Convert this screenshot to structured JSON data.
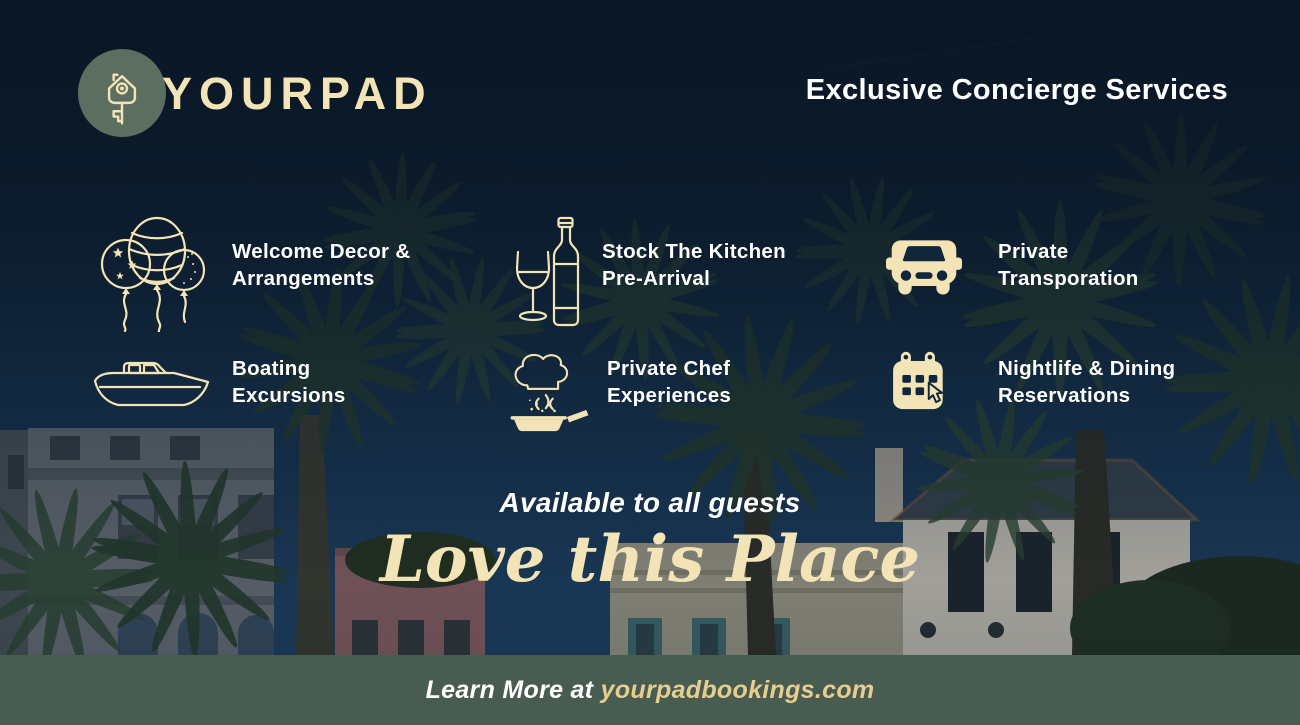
{
  "colors": {
    "navy_background": "#0f2133",
    "cream_accent": "#f2e4b6",
    "gold_link": "#e6cf8e",
    "sage_footer_bar": "#495c51",
    "logo_circle": "#5b6e60",
    "white_text": "#ffffff"
  },
  "header": {
    "brand": "YOURPAD",
    "logo_icon": "key-house-icon",
    "headline": "Exclusive Concierge Services"
  },
  "services": {
    "items": [
      {
        "icon": "balloons-icon",
        "lines": [
          "Welcome Decor &",
          "Arrangements"
        ]
      },
      {
        "icon": "wine-bottle-glass-icon",
        "lines": [
          "Stock The Kitchen",
          "Pre-Arrival"
        ]
      },
      {
        "icon": "car-icon",
        "lines": [
          "Private",
          "Transporation"
        ]
      },
      {
        "icon": "boat-icon",
        "lines": [
          "Boating",
          "Excursions"
        ]
      },
      {
        "icon": "chef-hat-pan-icon",
        "lines": [
          "Private Chef",
          "Experiences"
        ]
      },
      {
        "icon": "calendar-cursor-icon",
        "lines": [
          "Nightlife & Dining",
          "Reservations"
        ]
      }
    ]
  },
  "tagline": {
    "text": "Available to all guests",
    "script_text": "Love this Place"
  },
  "footer": {
    "prefix": "Learn More at ",
    "domain": "yourpadbookings.com"
  }
}
